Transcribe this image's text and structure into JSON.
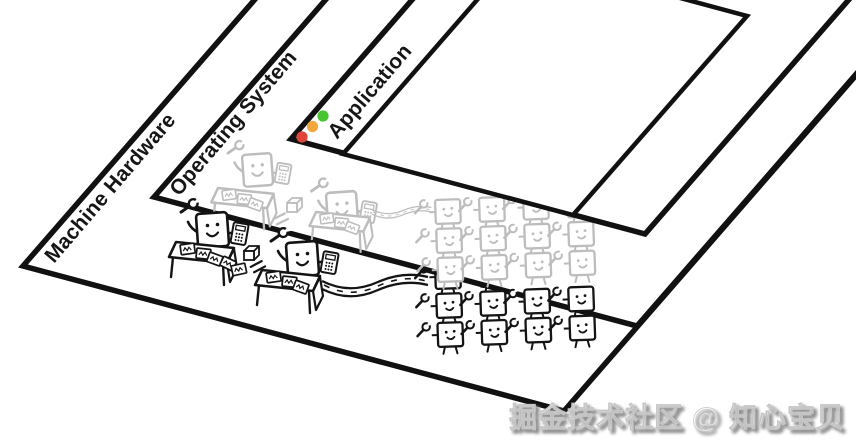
{
  "diagram": {
    "title": "Layered system diagram",
    "layers": [
      {
        "id": "machine-hardware",
        "label": "Machine Hardware"
      },
      {
        "id": "operating-system",
        "label": "Operating System"
      },
      {
        "id": "application",
        "label": "Application"
      }
    ],
    "window_controls": [
      {
        "name": "close",
        "color": "#df4538"
      },
      {
        "name": "minimize",
        "color": "#f0a73c"
      },
      {
        "name": "zoom",
        "color": "#47c432"
      }
    ],
    "ink_color": "#141414",
    "ghost_color": "#bdbdbd"
  },
  "scene": {
    "robot_grids": [
      {
        "variant": "ghost",
        "rows": 3,
        "cols": 4
      },
      {
        "variant": "ink",
        "rows": 3,
        "cols": 4
      }
    ],
    "worker_desks": {
      "ghost": 2,
      "ink": 2
    }
  },
  "watermark": {
    "text": "掘金技术社区 @ 知心宝贝"
  }
}
